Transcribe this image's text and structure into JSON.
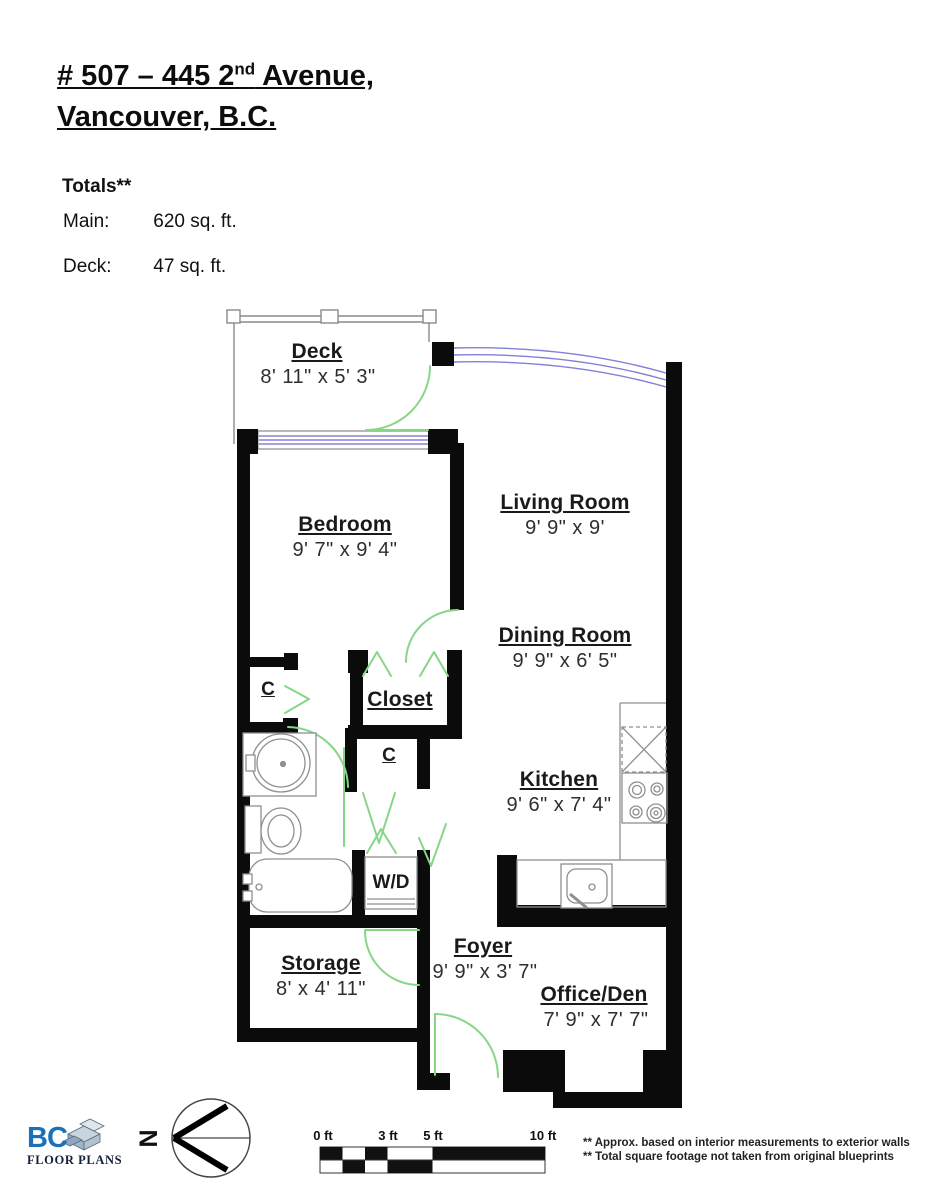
{
  "header": {
    "title_line1": {
      "prefix": "# 507 – 445 2",
      "superscript": "nd",
      "suffix": " Avenue,"
    },
    "title_line2": "Vancouver, B.C.",
    "totals_heading": "Totals**",
    "totals": [
      {
        "label": "Main:",
        "value": "620 sq. ft."
      },
      {
        "label": "Deck:",
        "value": "47 sq. ft."
      }
    ]
  },
  "floor_plan": {
    "rooms": [
      {
        "name": "Deck",
        "dims": "8' 11\" x 5' 3\""
      },
      {
        "name": "Bedroom",
        "dims": "9' 7\" x 9' 4\""
      },
      {
        "name": "Living Room",
        "dims": "9' 9\" x 9'"
      },
      {
        "name": "Dining Room",
        "dims": "9' 9\" x 6' 5\""
      },
      {
        "name": "Closet"
      },
      {
        "name": "Kitchen",
        "dims": "9' 6\" x 7' 4\""
      },
      {
        "name": "Storage",
        "dims": "8' x 4' 11\""
      },
      {
        "name": "Foyer",
        "dims": "9' 9\"  x 3' 7\""
      },
      {
        "name": "Office/Den",
        "dims": "7' 9\" x 7' 7\""
      }
    ],
    "closet_marks": {
      "c_left": "C",
      "c_mid": "C",
      "wd": "W/D"
    }
  },
  "footer": {
    "compass_label": "N",
    "scale_labels": [
      "0 ft",
      "3 ft",
      "5 ft",
      "10 ft"
    ],
    "footnotes": [
      "** Approx. based on interior measurements to exterior walls",
      "** Total square footage not taken from original blueprints"
    ],
    "logo": {
      "brand": "BC",
      "subtitle": "FLOOR PLANS"
    }
  },
  "colors": {
    "wall": "#0b0b0b",
    "door": "#87d687",
    "window": "#8080d8",
    "fixture": "#8f8f8f",
    "logo_blue": "#1a71b8"
  }
}
